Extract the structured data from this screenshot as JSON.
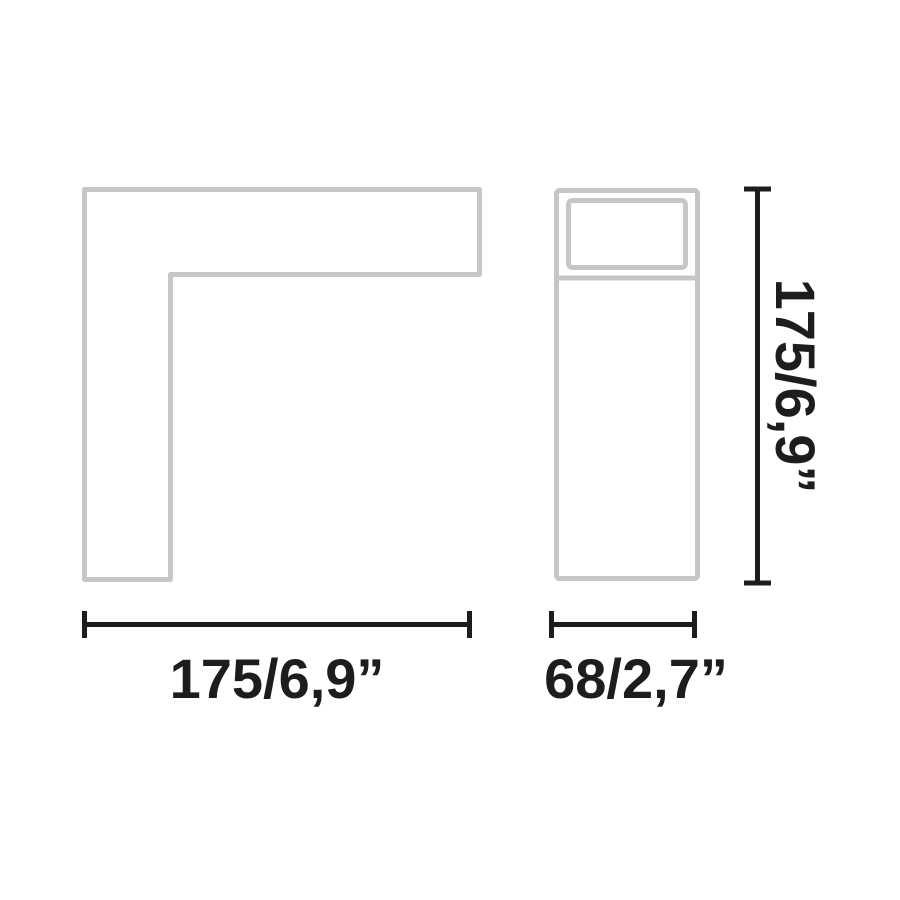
{
  "diagram": {
    "kind": "technical-dimension-drawing",
    "views": [
      {
        "id": "front-view",
        "shape": "l-shaped-profile"
      },
      {
        "id": "side-view",
        "shape": "tall-rectangle-with-top-panel"
      }
    ],
    "dimensions": {
      "front_width": "175/6,9”",
      "side_width": "68/2,7”",
      "height": "175/6,9”"
    },
    "colors": {
      "outline": "#c6c6c6",
      "dimension": "#1d1d1b",
      "background": "#ffffff"
    }
  }
}
